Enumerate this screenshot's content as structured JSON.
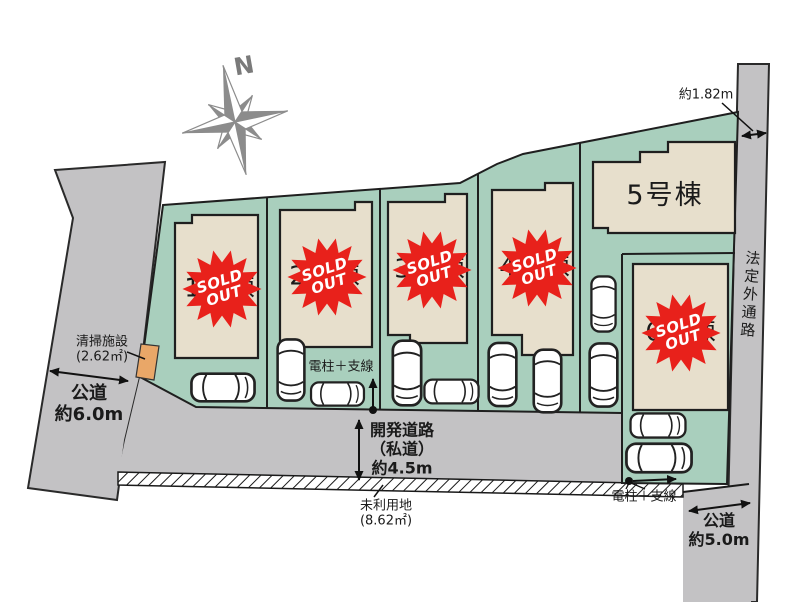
{
  "compass": {
    "label": "N"
  },
  "lots": [
    {
      "label": "1号棟",
      "sold": true
    },
    {
      "label": "2号棟",
      "sold": true
    },
    {
      "label": "3号棟",
      "sold": true
    },
    {
      "label": "4号棟",
      "sold": true
    },
    {
      "label": "5号棟",
      "sold": false
    },
    {
      "label": "6号棟",
      "sold": true
    }
  ],
  "sold_badge": {
    "line1": "SOLD",
    "line2": "OUT"
  },
  "roads": {
    "left_road": {
      "name": "公道",
      "width": "約6.0m"
    },
    "dev_road": {
      "line1": "開発道路",
      "line2": "（私道）",
      "line3": "約4.5m"
    },
    "right_path": {
      "name": "法定外通路"
    },
    "south_road": {
      "name": "公道",
      "width": "約5.0m"
    }
  },
  "annotations": {
    "cleaning_facility": {
      "line1": "清掃施設",
      "line2": "(2.62㎡)"
    },
    "unused_land": {
      "line1": "未利用地",
      "line2": "(8.62㎡)"
    },
    "pole_left": {
      "label": "電柱＋支線"
    },
    "pole_right": {
      "label": "電柱＋支線"
    },
    "setback": {
      "label": "約1.82m"
    }
  },
  "colors": {
    "parcel_green": "#a9cfbd",
    "house_beige": "#e7dfcc",
    "road_gray": "#c3c2c4",
    "sold_red": "#e8211b",
    "facility_orange": "#e9a768",
    "compass_gray": "#8c8c8c"
  }
}
